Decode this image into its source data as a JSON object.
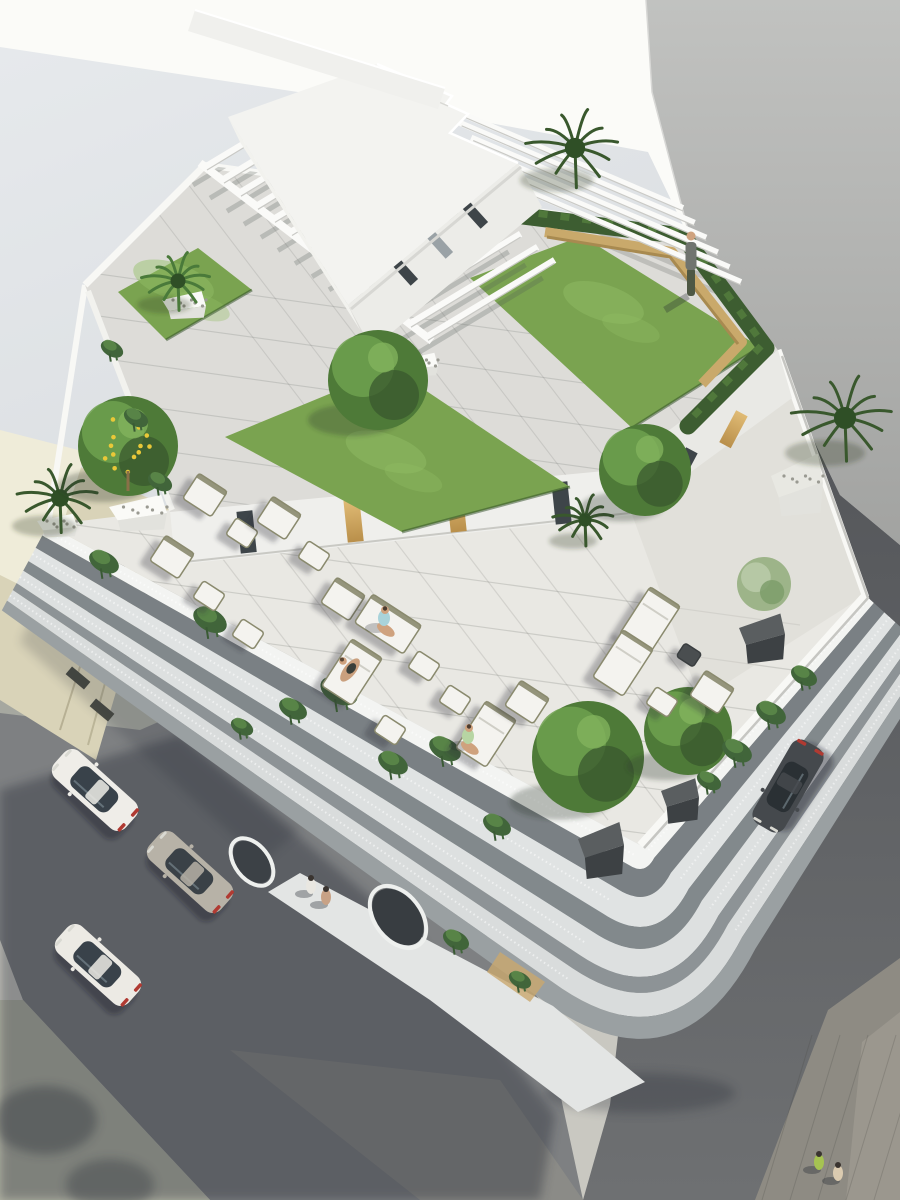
{
  "image": {
    "kind": "architectural aerial 3d render",
    "description": "Top-down aerial rendering of a white modern apartment building with a rooftop garden (lawns, pergola beams, hedges, wooden bench, penthouse), a lounge terrace with white cushioned furniture and seated people, balcony facades with hanging vines, surrounding streets with parked cars and pedestrians",
    "width": 900,
    "height": 1200
  },
  "colors": {
    "ground_sun": "#fbfbf8",
    "ground_shade": "#dde1e4",
    "wall": "#b3b4b2",
    "asphalt_dark": "#595b5f",
    "asphalt_left": "#7e8082",
    "sidewalk": "#c9c8c1",
    "pavers": "#a6a8a0",
    "beige_roof": "#efecd9",
    "beige_wall": "#d9d3b8",
    "white": "#f4f4f1",
    "deck": "#dddcd8",
    "terrace": "#e9e8e3",
    "lawn": "#7aa350",
    "lawn_light": "#92be65",
    "hedge": "#3d5d31",
    "foliage": "#4e7a38",
    "foliage_dark": "#39582d",
    "foliage_light": "#6fa14f",
    "bench": "#c9a96b",
    "gold": "#d3a95f",
    "cushion": "#f4f3ef",
    "frame": "#8a8a6e",
    "glass": "#39424a",
    "tail": "#b03a32",
    "skin": "#cfa27e",
    "shadow": "#232830"
  },
  "roof": {
    "lawn_patches": 3,
    "pergola_beams_southwest": 14,
    "pergola_beams_northeast": 6,
    "hedge_shape": "L-shaped",
    "bench": "wooden L-shaped bench",
    "standing_people": 1
  },
  "terrace_info": {
    "seats": 20,
    "seated_people": 3,
    "lemon_tree": 1,
    "palm_plants": 3,
    "olive_tree": 1
  },
  "street_info": {
    "cars": [
      {
        "color": "white",
        "street": "left"
      },
      {
        "color": "silver",
        "street": "left"
      },
      {
        "color": "white",
        "street": "left"
      },
      {
        "color": "dark-gray",
        "street": "right"
      }
    ],
    "pedestrians": 4
  },
  "vehicles": [
    {
      "x": 95,
      "y": 790,
      "rot": -48,
      "body": "#efede8",
      "glass": "#39424a"
    },
    {
      "x": 190,
      "y": 872,
      "rot": -48,
      "body": "#b7b2a7",
      "glass": "#3a4147"
    },
    {
      "x": 98,
      "y": 965,
      "rot": -48,
      "body": "#eceae4",
      "glass": "#39424a"
    },
    {
      "x": 788,
      "y": 786,
      "rot": -150,
      "body": "#45494d",
      "glass": "#2a3034"
    }
  ],
  "trees": [
    {
      "type": "palm",
      "x": 575,
      "y": 148,
      "r": 46
    },
    {
      "type": "palm",
      "x": 845,
      "y": 418,
      "r": 50
    },
    {
      "type": "palm",
      "x": 60,
      "y": 498,
      "r": 40
    },
    {
      "type": "palm",
      "x": 585,
      "y": 520,
      "r": 30
    },
    {
      "type": "round",
      "x": 378,
      "y": 380,
      "r": 50
    },
    {
      "type": "round",
      "x": 645,
      "y": 470,
      "r": 46
    },
    {
      "type": "fern",
      "x": 178,
      "y": 281,
      "r": 34
    },
    {
      "type": "lemon",
      "x": 128,
      "y": 446,
      "r": 50
    },
    {
      "type": "olive",
      "x": 764,
      "y": 584,
      "r": 27
    },
    {
      "type": "round",
      "x": 588,
      "y": 757,
      "r": 56
    },
    {
      "type": "round",
      "x": 688,
      "y": 731,
      "r": 44
    }
  ],
  "planters": [
    {
      "kind": "white",
      "x": 138,
      "y": 509,
      "w": 58,
      "h": 34
    },
    {
      "kind": "white",
      "x": 184,
      "y": 302,
      "w": 44,
      "h": 26
    },
    {
      "kind": "white",
      "x": 57,
      "y": 523,
      "w": 40,
      "h": 22
    },
    {
      "kind": "white",
      "x": 420,
      "y": 362,
      "w": 36,
      "h": 22
    },
    {
      "kind": "pebble",
      "x": 797,
      "y": 478,
      "w": 52,
      "h": 58
    },
    {
      "kind": "dark",
      "x": 762,
      "y": 632,
      "w": 46,
      "h": 44
    },
    {
      "kind": "dark",
      "x": 601,
      "y": 843,
      "w": 46,
      "h": 50
    },
    {
      "kind": "dark",
      "x": 680,
      "y": 795,
      "w": 38,
      "h": 40
    }
  ],
  "furniture": [
    {
      "x": 205,
      "y": 495,
      "t": "chair"
    },
    {
      "x": 242,
      "y": 533,
      "t": "pouf"
    },
    {
      "x": 172,
      "y": 557,
      "t": "chair"
    },
    {
      "x": 209,
      "y": 596,
      "t": "pouf"
    },
    {
      "x": 279,
      "y": 518,
      "t": "chair"
    },
    {
      "x": 314,
      "y": 556,
      "t": "pouf"
    },
    {
      "x": 248,
      "y": 634,
      "t": "pouf"
    },
    {
      "x": 343,
      "y": 599,
      "t": "chair"
    },
    {
      "x": 388,
      "y": 624,
      "t": "sofa"
    },
    {
      "x": 352,
      "y": 672,
      "t": "lounger"
    },
    {
      "x": 424,
      "y": 666,
      "t": "pouf"
    },
    {
      "x": 455,
      "y": 700,
      "t": "pouf"
    },
    {
      "x": 390,
      "y": 730,
      "t": "pouf"
    },
    {
      "x": 486,
      "y": 734,
      "t": "lounger"
    },
    {
      "x": 527,
      "y": 702,
      "t": "chair"
    },
    {
      "x": 650,
      "y": 620,
      "t": "lounger"
    },
    {
      "x": 623,
      "y": 663,
      "t": "lounger"
    },
    {
      "x": 689,
      "y": 655,
      "t": "table"
    },
    {
      "x": 662,
      "y": 702,
      "t": "pouf"
    },
    {
      "x": 712,
      "y": 692,
      "t": "chair"
    }
  ],
  "people": [
    {
      "pose": "stand",
      "x": 691,
      "y": 252,
      "shirt": "#70746f",
      "pants": "#4e5844"
    },
    {
      "pose": "sit",
      "x": 384,
      "y": 618,
      "shirt": "#a9d3da"
    },
    {
      "pose": "lie",
      "x": 350,
      "y": 670,
      "shirt": "#caa07e"
    },
    {
      "pose": "sit",
      "x": 468,
      "y": 736,
      "shirt": "#b7d5a3"
    },
    {
      "pose": "walk",
      "x": 311,
      "y": 886,
      "shirt": "#e9e7e1"
    },
    {
      "pose": "walk",
      "x": 326,
      "y": 897,
      "shirt": "#c8a286"
    },
    {
      "pose": "walk",
      "x": 819,
      "y": 1162,
      "shirt": "#a6c352"
    },
    {
      "pose": "walk",
      "x": 838,
      "y": 1173,
      "shirt": "#dbcbb0"
    }
  ],
  "vines": [
    {
      "x": 104,
      "y": 562,
      "r": 16
    },
    {
      "x": 210,
      "y": 620,
      "r": 18
    },
    {
      "x": 339,
      "y": 691,
      "r": 20
    },
    {
      "x": 445,
      "y": 749,
      "r": 17
    },
    {
      "x": 293,
      "y": 709,
      "r": 15
    },
    {
      "x": 393,
      "y": 763,
      "r": 16
    },
    {
      "x": 497,
      "y": 825,
      "r": 15
    },
    {
      "x": 804,
      "y": 676,
      "r": 14
    },
    {
      "x": 771,
      "y": 713,
      "r": 16
    },
    {
      "x": 737,
      "y": 751,
      "r": 16
    },
    {
      "x": 709,
      "y": 781,
      "r": 13
    },
    {
      "x": 112,
      "y": 349,
      "r": 12
    },
    {
      "x": 136,
      "y": 418,
      "r": 13
    },
    {
      "x": 160,
      "y": 482,
      "r": 13
    },
    {
      "x": 242,
      "y": 727,
      "r": 12
    },
    {
      "x": 456,
      "y": 940,
      "r": 14
    },
    {
      "x": 520,
      "y": 980,
      "r": 12
    }
  ]
}
